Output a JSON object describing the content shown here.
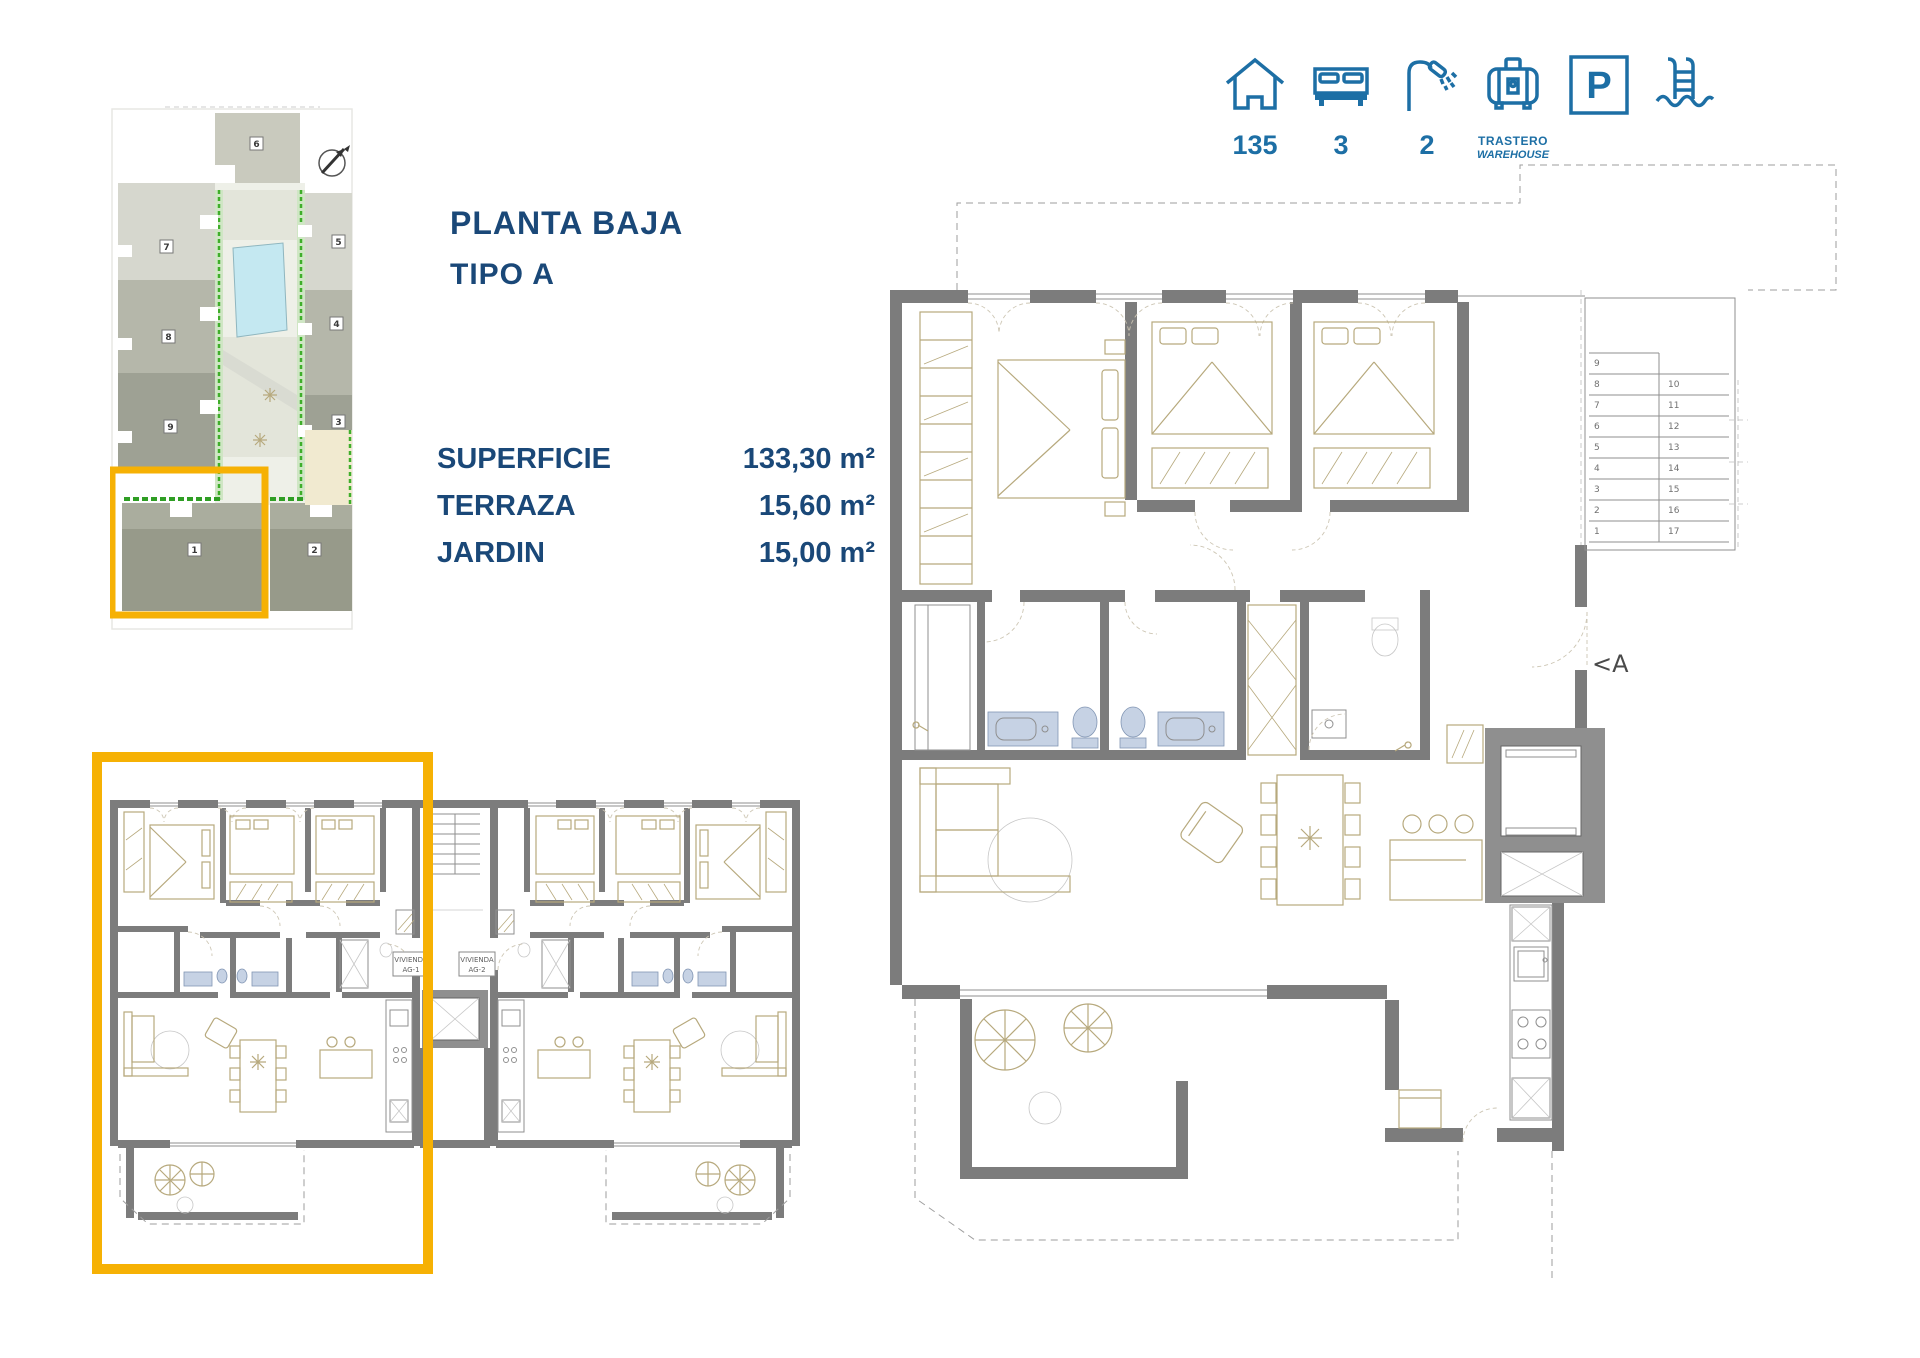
{
  "title": {
    "line1": "PLANTA BAJA",
    "line2": "TIPO A"
  },
  "specs": {
    "rows": [
      {
        "label": "SUPERFICIE",
        "value": "133,30 m²"
      },
      {
        "label": "TERRAZA",
        "value": "15,60 m²"
      },
      {
        "label": "JARDIN",
        "value": "15,00 m²"
      }
    ]
  },
  "amenities": {
    "area": {
      "icon": "house-icon",
      "value": "135"
    },
    "bedrooms": {
      "icon": "bed-icon",
      "value": "3"
    },
    "bathrooms": {
      "icon": "shower-icon",
      "value": "2"
    },
    "storage": {
      "icon": "storage-icon",
      "line1": "TRASTERO",
      "line2": "WAREHOUSE"
    },
    "parking": {
      "icon": "parking-icon",
      "letter": "P"
    },
    "pool": {
      "icon": "pool-icon"
    }
  },
  "site_plan": {
    "blocks": [
      {
        "num": "6"
      },
      {
        "num": "7"
      },
      {
        "num": "8"
      },
      {
        "num": "9"
      },
      {
        "num": "5"
      },
      {
        "num": "4"
      },
      {
        "num": "3"
      },
      {
        "num": "1"
      },
      {
        "num": "2"
      }
    ]
  },
  "main_plan": {
    "section_label": "<A",
    "stairs_left": [
      "9",
      "8",
      "7",
      "6",
      "5",
      "4",
      "3",
      "2",
      "1"
    ],
    "stairs_right": [
      "10",
      "11",
      "12",
      "13",
      "14",
      "15",
      "16",
      "17"
    ]
  },
  "small_plan": {
    "unit1": {
      "line1": "VIVIENDA",
      "line2": "AG-1"
    },
    "unit2": {
      "line1": "VIVIENDA",
      "line2": "AG-2"
    }
  },
  "colors": {
    "accent_yellow": "#f6b104",
    "brand_blue": "#1d6fa5",
    "navy_text": "#1a4878"
  }
}
